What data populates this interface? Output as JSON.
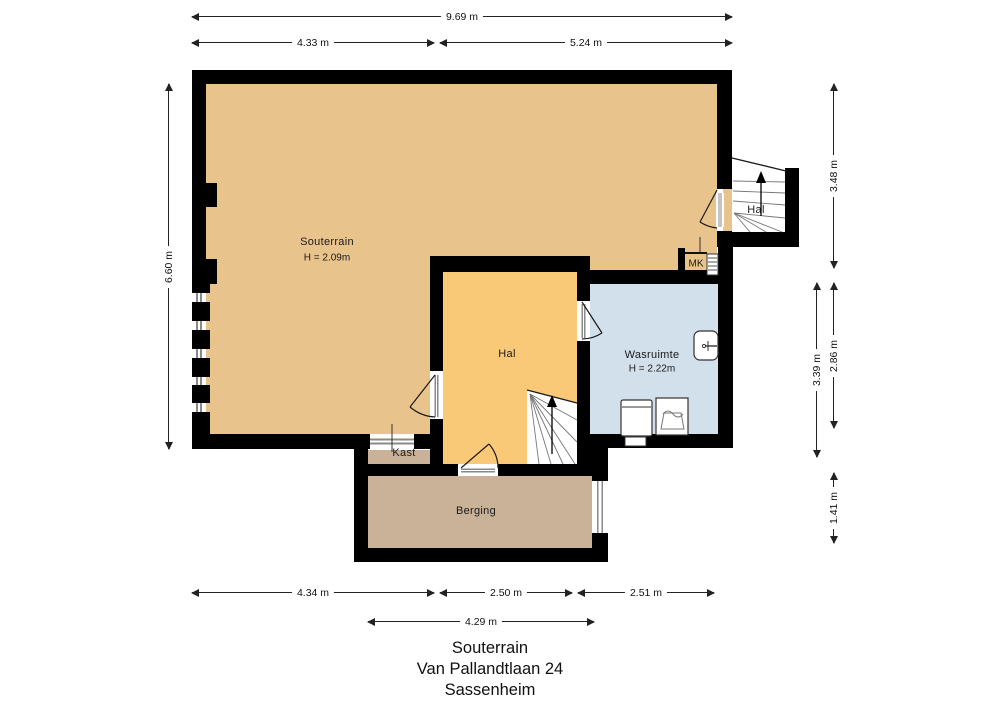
{
  "title_block": {
    "line1": "Souterrain",
    "line2": "Van Pallandtlaan 24",
    "line3": "Sassenheim"
  },
  "rooms": {
    "souterrain": {
      "name": "Souterrain",
      "height": "H = 2.09m"
    },
    "hal_center": {
      "name": "Hal"
    },
    "hal_upper": {
      "name": "Hal"
    },
    "wasruimte": {
      "name": "Wasruimte",
      "height": "H = 2.22m"
    },
    "mk": {
      "name": "MK"
    },
    "kast": {
      "name": "Kast"
    },
    "berging": {
      "name": "Berging"
    }
  },
  "dimensions": {
    "top_total": "9.69 m",
    "top_left": "4.33 m",
    "top_right": "5.24 m",
    "left_total": "6.60 m",
    "right_upper": "3.48 m",
    "right_mid_inner": "3.39 m",
    "right_mid_outer": "2.86 m",
    "right_lower": "1.41 m",
    "bottom_left": "4.34 m",
    "bottom_mid": "2.50 m",
    "bottom_right": "2.51 m",
    "bottom_berging": "4.29 m"
  },
  "colors": {
    "wall": "#000000",
    "souterrain": "#e9c38c",
    "hal": "#f9c977",
    "wasruimte": "#d2e0ec",
    "berging": "#c9b297",
    "stair": "#ffffff",
    "line": "#1a1a1a"
  }
}
